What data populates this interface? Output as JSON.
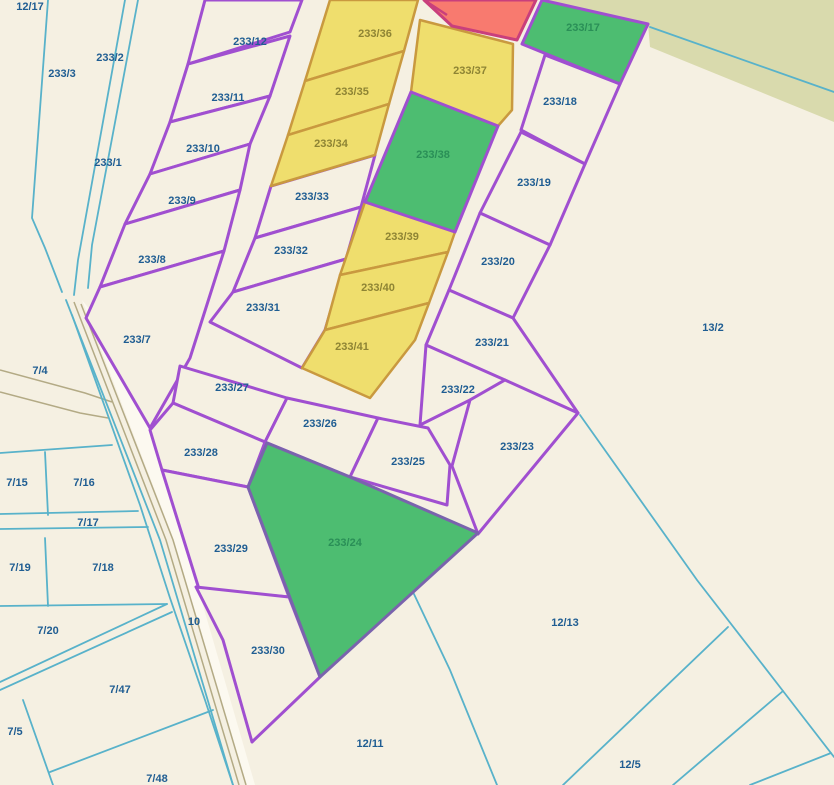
{
  "map": {
    "colors": {
      "background": "#f5f0e2",
      "khaki_band": "#d9daad",
      "road_fill": "#fcf9f0",
      "road_edge": "#b3aa85",
      "boundary_purple": "#a04fd0",
      "boundary_cyan": "#58b2ca",
      "boundary_amber": "#c9993f",
      "boundary_crimson": "#c93f7c",
      "parcel_yellow": "#efde6d",
      "parcel_green": "#4dbd71",
      "parcel_red": "#f87a6f",
      "label_navy": "#1f5d92",
      "label_olive": "#8e8434",
      "label_green": "#2a8f57"
    },
    "styles": {
      "plain": {
        "fill": "#f5f0e2",
        "stroke": "#a04fd0",
        "w": 3
      },
      "yellow": {
        "fill": "#efde6d",
        "stroke": "#c9993f",
        "w": 2.5
      },
      "green": {
        "fill": "#4dbd71",
        "stroke": "#a04fd0",
        "w": 3
      },
      "green2": {
        "fill": "#4dbd71",
        "stroke": "#7a63ad",
        "w": 3
      },
      "red": {
        "fill": "#f87a6f",
        "stroke": "#c93f7c",
        "w": 3
      }
    },
    "khaki_band_points": "545,0 834,0 834,122 650,47 648,24",
    "road_fill_points": "82,300 174,540 247,785 255,785 184,540 151,424 90,310",
    "khaki_lines": [
      "74,302 166,540 239,785",
      "81,304 173,540 246,785",
      "0,370 85,393 112,402",
      "0,392 80,413 108,418"
    ],
    "cyan_lines": [
      "48,0 32,218 45,248 62,292",
      "125,0 78,260 74,295",
      "138,0 92,245 88,288",
      "66,300 160,540 233,785",
      "72,315 140,505 170,598 205,700 233,785",
      "0,453 112,445",
      "45,452 48,515",
      "0,514 138,511",
      "0,529 148,527",
      "45,538 48,606",
      "0,606 167,604",
      "167,604 0,682",
      "172,612 0,690",
      "23,700 53,785",
      "50,772 213,710",
      "413,592 450,670 497,785",
      "580,415 697,580 783,691 834,757",
      "728,627 563,785",
      "783,691 673,785",
      "831,753 750,785",
      "650,27 834,92"
    ],
    "red_inner_line": "424,0 447,15",
    "parcels": [
      {
        "id": "233-12",
        "type": "plain",
        "points": "205,0 302,0 290,32 188,64"
      },
      {
        "id": "233-11",
        "type": "plain",
        "points": "188,64 290,36 270,96 170,122"
      },
      {
        "id": "233-10",
        "type": "plain",
        "points": "170,122 270,96 250,144 150,174"
      },
      {
        "id": "233-9",
        "type": "plain",
        "points": "150,174 250,144 240,190 125,224"
      },
      {
        "id": "233-8",
        "type": "plain",
        "points": "125,224 240,190 224,251 100,287"
      },
      {
        "id": "233-7",
        "type": "plain",
        "points": "100,287 224,251 190,358 150,428 86,318"
      },
      {
        "id": "233-33",
        "type": "plain",
        "points": "271,186 375,155 361,207 255,238"
      },
      {
        "id": "233-32",
        "type": "plain",
        "points": "255,238 361,207 346,259 233,292"
      },
      {
        "id": "233-31",
        "type": "plain",
        "points": "233,292 346,259 325,330 302,368 210,322"
      },
      {
        "id": "233-18",
        "type": "plain",
        "points": "545,55 620,84 585,164 521,130"
      },
      {
        "id": "233-19",
        "type": "plain",
        "points": "521,132 585,164 550,245 480,213"
      },
      {
        "id": "233-20",
        "type": "plain",
        "points": "480,213 550,245 513,318 449,290"
      },
      {
        "id": "233-21",
        "type": "plain",
        "points": "449,290 513,318 578,413 426,345"
      },
      {
        "id": "233-22",
        "type": "plain",
        "points": "426,345 505,380 470,400 420,425"
      },
      {
        "id": "233-23",
        "type": "plain",
        "points": "505,380 578,413 478,534 452,466 470,400"
      },
      {
        "id": "233-27",
        "type": "plain",
        "points": "180,366 287,398 265,442 173,403"
      },
      {
        "id": "233-26",
        "type": "plain",
        "points": "287,398 378,418 350,477 265,442"
      },
      {
        "id": "233-25",
        "type": "plain",
        "points": "378,418 428,428 450,465 447,505 350,477"
      },
      {
        "id": "233-28",
        "type": "plain",
        "points": "173,403 265,442 248,487 162,470 150,430"
      },
      {
        "id": "233-29",
        "type": "plain",
        "points": "162,470 248,487 289,597 199,589"
      },
      {
        "id": "233-30",
        "type": "plain",
        "points": "196,587 289,597 320,677 252,742 223,640"
      },
      {
        "id": "233-36",
        "type": "yellow",
        "points": "330,0 418,0 404,51 305,81"
      },
      {
        "id": "233-35",
        "type": "yellow",
        "points": "305,81 404,51 389,104 288,135"
      },
      {
        "id": "233-34",
        "type": "yellow",
        "points": "288,135 389,104 375,155 271,186"
      },
      {
        "id": "233-37",
        "type": "yellow",
        "points": "420,20 513,44 512,110 498,126 411,92"
      },
      {
        "id": "233-39",
        "type": "yellow",
        "points": "365,202 455,232 448,252 340,275"
      },
      {
        "id": "233-40",
        "type": "yellow",
        "points": "340,275 448,252 429,303 325,330"
      },
      {
        "id": "233-41",
        "type": "yellow",
        "points": "325,330 429,303 415,340 370,398 302,368"
      },
      {
        "id": "233-38",
        "type": "green",
        "points": "411,92 498,126 455,232 365,202"
      },
      {
        "id": "233-17",
        "type": "green",
        "points": "542,0 648,24 620,84 522,44"
      },
      {
        "id": "233-24",
        "type": "green2",
        "points": "267,443 350,477 478,533 320,677 248,487"
      },
      {
        "id": "red",
        "type": "red",
        "points": "424,0 536,0 517,40 452,26"
      }
    ],
    "labels": [
      {
        "text": "12/17",
        "x": 30,
        "y": 7,
        "cls": "navy"
      },
      {
        "text": "233/3",
        "x": 62,
        "y": 74,
        "cls": "navy"
      },
      {
        "text": "233/2",
        "x": 110,
        "y": 58,
        "cls": "navy"
      },
      {
        "text": "233/1",
        "x": 108,
        "y": 163,
        "cls": "navy"
      },
      {
        "text": "233/12",
        "x": 250,
        "y": 42,
        "cls": "navy"
      },
      {
        "text": "233/11",
        "x": 228,
        "y": 98,
        "cls": "navy"
      },
      {
        "text": "233/10",
        "x": 203,
        "y": 149,
        "cls": "navy"
      },
      {
        "text": "233/9",
        "x": 182,
        "y": 201,
        "cls": "navy"
      },
      {
        "text": "233/8",
        "x": 152,
        "y": 260,
        "cls": "navy"
      },
      {
        "text": "233/7",
        "x": 137,
        "y": 340,
        "cls": "navy"
      },
      {
        "text": "233/36",
        "x": 375,
        "y": 34,
        "cls": "olive"
      },
      {
        "text": "233/35",
        "x": 352,
        "y": 92,
        "cls": "olive"
      },
      {
        "text": "233/34",
        "x": 331,
        "y": 144,
        "cls": "olive"
      },
      {
        "text": "233/37",
        "x": 470,
        "y": 71,
        "cls": "olive"
      },
      {
        "text": "233/38",
        "x": 433,
        "y": 155,
        "cls": "green"
      },
      {
        "text": "233/39",
        "x": 402,
        "y": 237,
        "cls": "olive"
      },
      {
        "text": "233/40",
        "x": 378,
        "y": 288,
        "cls": "olive"
      },
      {
        "text": "233/41",
        "x": 352,
        "y": 347,
        "cls": "olive"
      },
      {
        "text": "233/33",
        "x": 312,
        "y": 197,
        "cls": "navy"
      },
      {
        "text": "233/32",
        "x": 291,
        "y": 251,
        "cls": "navy"
      },
      {
        "text": "233/31",
        "x": 263,
        "y": 308,
        "cls": "navy"
      },
      {
        "text": "233/17",
        "x": 583,
        "y": 28,
        "cls": "green"
      },
      {
        "text": "233/18",
        "x": 560,
        "y": 102,
        "cls": "navy"
      },
      {
        "text": "233/19",
        "x": 534,
        "y": 183,
        "cls": "navy"
      },
      {
        "text": "233/20",
        "x": 498,
        "y": 262,
        "cls": "navy"
      },
      {
        "text": "233/21",
        "x": 492,
        "y": 343,
        "cls": "navy"
      },
      {
        "text": "233/22",
        "x": 458,
        "y": 390,
        "cls": "navy"
      },
      {
        "text": "233/23",
        "x": 517,
        "y": 447,
        "cls": "navy"
      },
      {
        "text": "233/27",
        "x": 232,
        "y": 388,
        "cls": "navy"
      },
      {
        "text": "233/26",
        "x": 320,
        "y": 424,
        "cls": "navy"
      },
      {
        "text": "233/25",
        "x": 408,
        "y": 462,
        "cls": "navy"
      },
      {
        "text": "233/28",
        "x": 201,
        "y": 453,
        "cls": "navy"
      },
      {
        "text": "233/29",
        "x": 231,
        "y": 549,
        "cls": "navy"
      },
      {
        "text": "233/30",
        "x": 268,
        "y": 651,
        "cls": "navy"
      },
      {
        "text": "233/24",
        "x": 345,
        "y": 543,
        "cls": "green"
      },
      {
        "text": "13/2",
        "x": 713,
        "y": 328,
        "cls": "navy"
      },
      {
        "text": "7/4",
        "x": 40,
        "y": 371,
        "cls": "navy"
      },
      {
        "text": "7/15",
        "x": 17,
        "y": 483,
        "cls": "navy"
      },
      {
        "text": "7/16",
        "x": 84,
        "y": 483,
        "cls": "navy"
      },
      {
        "text": "7/17",
        "x": 88,
        "y": 523,
        "cls": "navy"
      },
      {
        "text": "7/19",
        "x": 20,
        "y": 568,
        "cls": "navy"
      },
      {
        "text": "7/18",
        "x": 103,
        "y": 568,
        "cls": "navy"
      },
      {
        "text": "7/20",
        "x": 48,
        "y": 631,
        "cls": "navy"
      },
      {
        "text": "10",
        "x": 194,
        "y": 622,
        "cls": "navy"
      },
      {
        "text": "12/13",
        "x": 565,
        "y": 623,
        "cls": "navy"
      },
      {
        "text": "7/47",
        "x": 120,
        "y": 690,
        "cls": "navy"
      },
      {
        "text": "7/5",
        "x": 15,
        "y": 732,
        "cls": "navy"
      },
      {
        "text": "12/11",
        "x": 370,
        "y": 744,
        "cls": "navy"
      },
      {
        "text": "12/5",
        "x": 630,
        "y": 765,
        "cls": "navy"
      },
      {
        "text": "7/48",
        "x": 157,
        "y": 779,
        "cls": "navy"
      }
    ]
  }
}
